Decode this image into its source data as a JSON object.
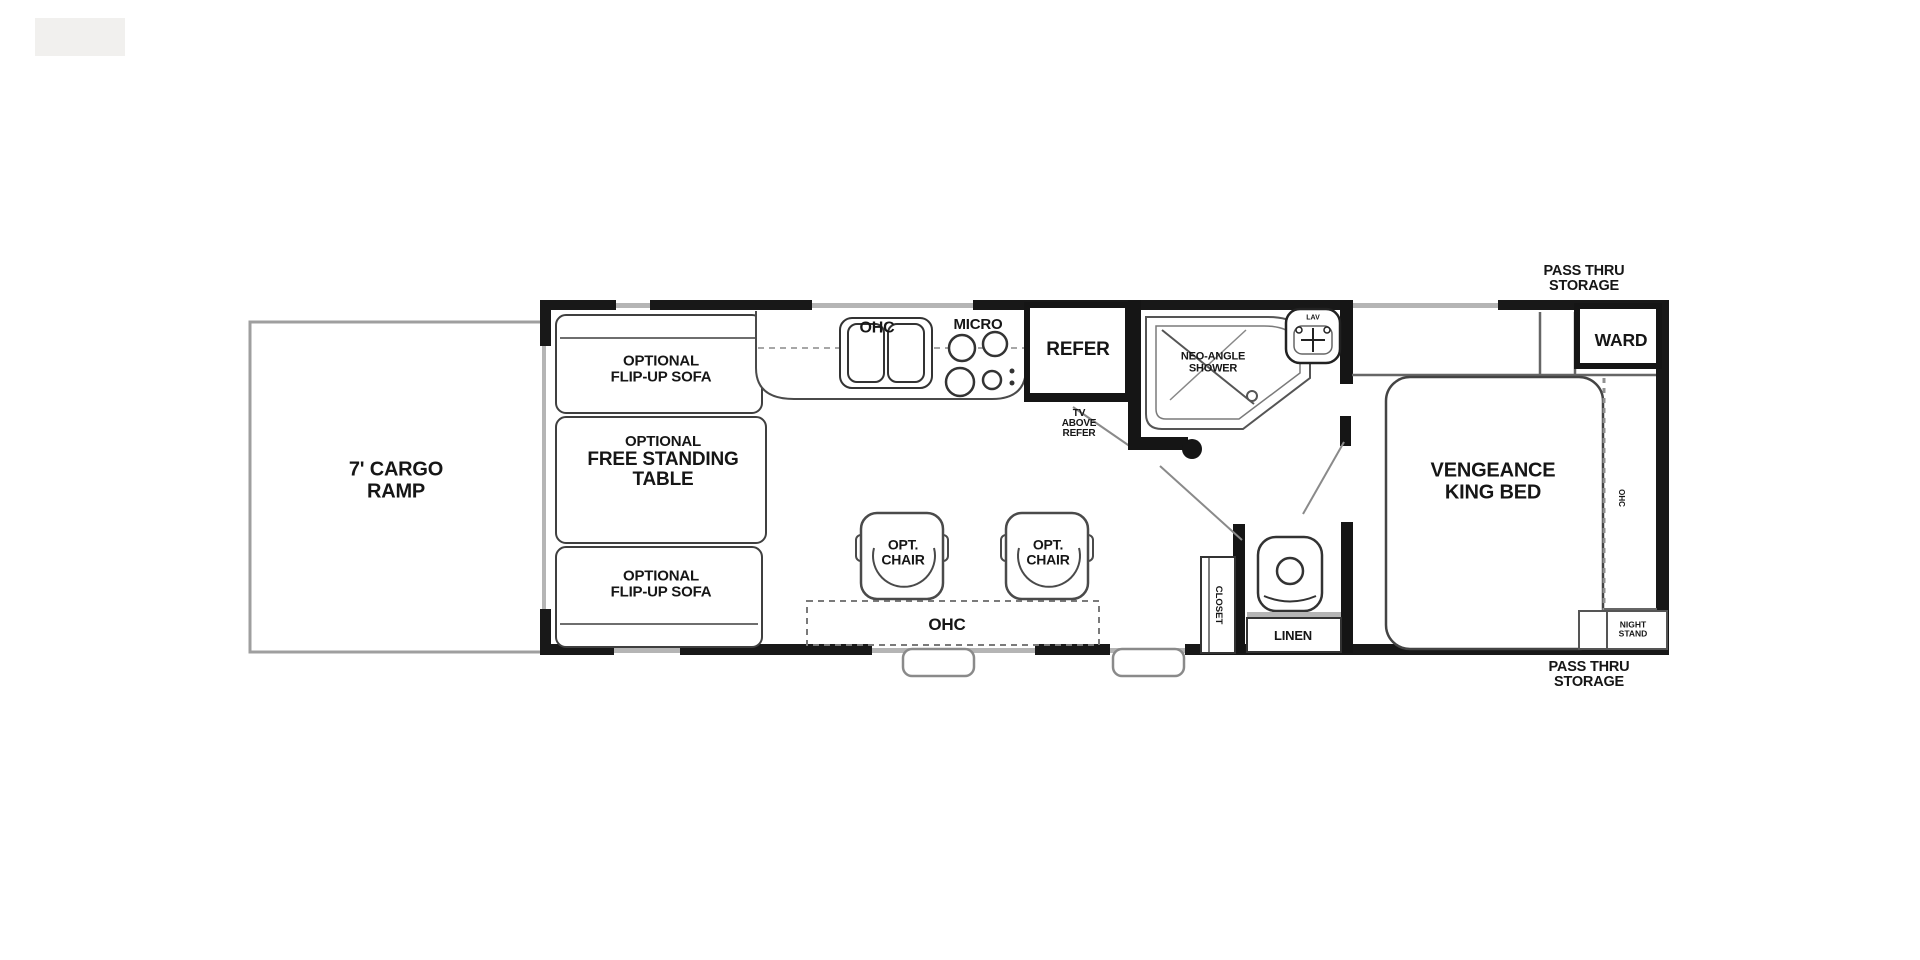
{
  "diagram_type": "rv-floor-plan",
  "colors": {
    "wall": "#181818",
    "furniture_line": "#4a4a4a",
    "window_line": "#b5b5b5",
    "text": "#161616",
    "background": "#ffffff"
  },
  "labels": {
    "ramp": {
      "l1": "7' CARGO",
      "l2": "RAMP"
    },
    "sofa_top": {
      "l1": "OPTIONAL",
      "l2": "FLIP-UP SOFA"
    },
    "table": {
      "l1": "OPTIONAL",
      "l2": "FREE STANDING",
      "l3": "TABLE"
    },
    "sofa_bottom": {
      "l1": "OPTIONAL",
      "l2": "FLIP-UP SOFA"
    },
    "kitchen_ohc": "OHC",
    "micro": "MICRO",
    "refer": "REFER",
    "tv_above_refer": {
      "l1": "TV",
      "l2": "ABOVE",
      "l3": "REFER"
    },
    "shower": {
      "l1": "NEO-ANGLE",
      "l2": "SHOWER"
    },
    "lav": "LAV",
    "chair": {
      "l1": "OPT.",
      "l2": "CHAIR"
    },
    "ohc_bottom": "OHC",
    "closet": "CLOSET",
    "linen": "LINEN",
    "ward": "WARD",
    "bed": {
      "l1": "VENGEANCE",
      "l2": "KING BED"
    },
    "bed_ohc": "OHC",
    "night_stand": {
      "l1": "NIGHT",
      "l2": "STAND"
    },
    "pass_thru_top": {
      "l1": "PASS THRU",
      "l2": "STORAGE"
    },
    "pass_thru_bottom": {
      "l1": "PASS THRU",
      "l2": "STORAGE"
    }
  }
}
